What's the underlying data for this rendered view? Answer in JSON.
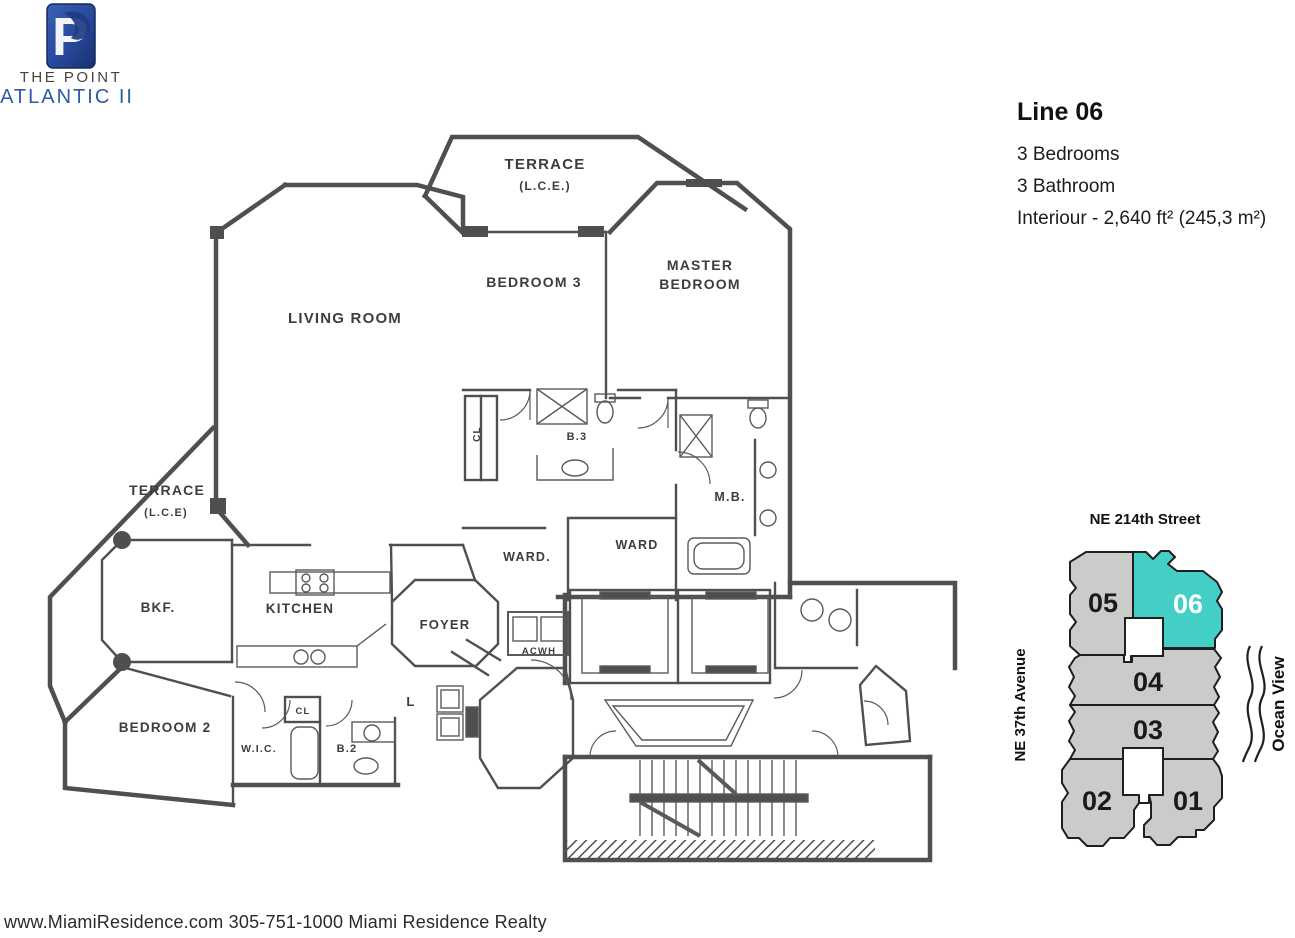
{
  "branding": {
    "monogram": "P",
    "name_top": "THE POINT",
    "name_bottom": "ATLANTIC II"
  },
  "specs": {
    "title": "Line 06",
    "lines": [
      "3 Bedrooms",
      "3 Bathroom",
      "Interiour - 2,640 ft² (245,3 m²)"
    ]
  },
  "floorplan": {
    "labels": {
      "terrace_top": "TERRACE",
      "terrace_top_sub": "(L.C.E.)",
      "bedroom3": "BEDROOM 3",
      "master1": "MASTER",
      "master2": "BEDROOM",
      "living": "LIVING ROOM",
      "terrace_left": "TERRACE",
      "terrace_left_sub": "(L.C.E)",
      "bkf": "BKF.",
      "kitchen": "KITCHEN",
      "foyer": "FOYER",
      "ward1": "WARD.",
      "ward2": "WARD",
      "mb": "M.B.",
      "b3": "B.3",
      "cl_b3": "CL",
      "acwh": "ACWH",
      "laundry": "L",
      "cl_small": "CL",
      "wic": "W.I.C.",
      "b2": "B.2",
      "bedroom2": "BEDROOM 2"
    }
  },
  "keyplan": {
    "street": "NE 214th Street",
    "avenue": "NE 37th Avenue",
    "ocean": "Ocean View",
    "highlight_unit": "06",
    "units": [
      {
        "label": "05"
      },
      {
        "label": "06"
      },
      {
        "label": "04"
      },
      {
        "label": "03"
      },
      {
        "label": "02"
      },
      {
        "label": "01"
      }
    ],
    "colors": {
      "unit": "#c9ccc8",
      "highlight": "#44cfc6",
      "outline": "#1f1f1f"
    }
  },
  "footer": {
    "text": "www.MiamiResidence.com 305-751-1000 Miami Residence Realty"
  }
}
